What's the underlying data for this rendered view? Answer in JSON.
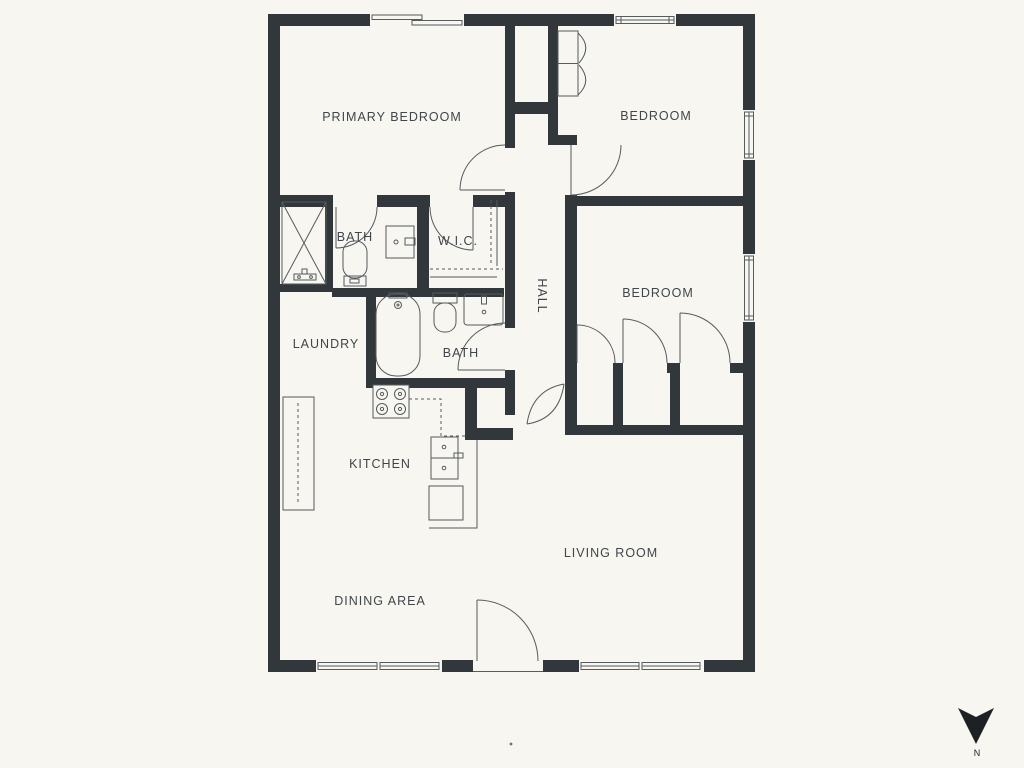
{
  "title": "apartment-floor-plan",
  "colors": {
    "background": "#f7f6f1",
    "wall": "#31373b",
    "line": "#565b5e",
    "label": "#40464a",
    "compass": "#1d2124"
  },
  "labels": {
    "primary_bedroom": "PRIMARY BEDROOM",
    "bedroom_top": "BEDROOM",
    "bath_upper": "BATH",
    "wic": "W.I.C.",
    "hall": "HALL",
    "bedroom_mid": "BEDROOM",
    "laundry": "LAUNDRY",
    "bath_lower": "BATH",
    "kitchen": "KITCHEN",
    "living_room": "LIVING ROOM",
    "dining_area": "DINING AREA"
  },
  "compass": {
    "label": "N"
  }
}
